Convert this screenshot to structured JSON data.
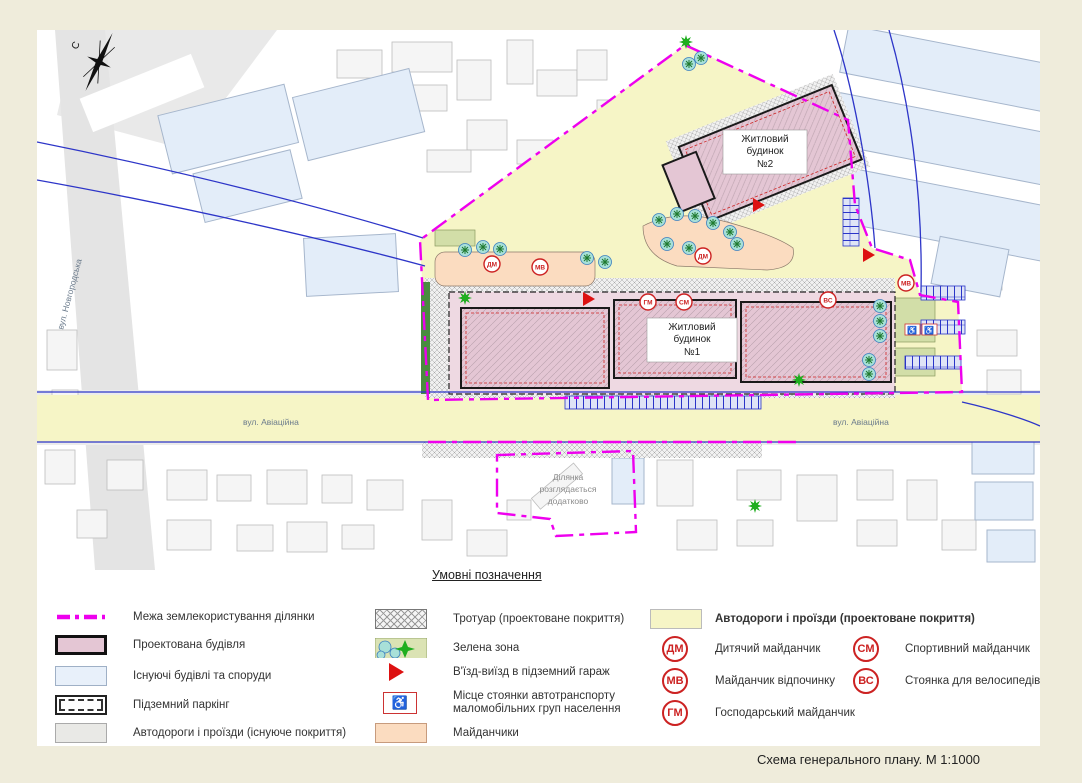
{
  "page": {
    "title": "Схема  генерального плану. М 1:1000"
  },
  "legend": {
    "heading": "Умовні позначення",
    "items": {
      "boundary": "Межа землекористування ділянки",
      "projected_building": "Проектована будівля",
      "existing_buildings": "Існуючі будівлі та споруди",
      "underground_parking": "Підземний паркінг",
      "roads_existing": "Автодороги і проїзди (існуюче покриття)",
      "sidewalk": "Тротуар (проектоване покриття)",
      "green_zone": "Зелена зона",
      "garage_entrance": "В'їзд-виїзд в підземний гараж",
      "disabled_parking": [
        "Місце стоянки автотранспорту",
        "маломобільних груп населення"
      ],
      "playgrounds": "Майданчики",
      "roads_projected": "Автодороги і проїзди (проектоване покриття)"
    },
    "badges": [
      {
        "code": "ДМ",
        "label": "Дитячий майданчик"
      },
      {
        "code": "МВ",
        "label": "Майданчик відпочинку"
      },
      {
        "code": "ГМ",
        "label": "Господарський майданчик"
      },
      {
        "code": "СМ",
        "label": "Спортивний майданчик"
      },
      {
        "code": "ВС",
        "label": "Стоянка для велосипедів"
      }
    ]
  },
  "map": {
    "compass": "С",
    "street_novgorodska": "вул. Новгородська",
    "street_aviatsiina": "вул. Авіаційна",
    "house1": [
      "Житловий",
      "будинок",
      "№1"
    ],
    "house2": [
      "Житловий",
      "будинок",
      "№2"
    ],
    "extra_plot": [
      "Ділянка",
      "розглядається",
      "додатково"
    ],
    "badges": [
      "ДМ",
      "МВ",
      "ДМ",
      "ГМ",
      "СМ",
      "ВС",
      "МВ"
    ],
    "wheelchair_icon": "♿"
  },
  "colors": {
    "background": "#efecdb",
    "boundary_magenta": "#ee00ee",
    "projected_building_pink": "#e4c6d4",
    "existing_building_blue": "#e3edf9",
    "road_projected_yellow": "#f6f5c6",
    "playground_peach": "#fbdcc0",
    "green_zone": "#d2dea8",
    "badge_red": "#cc2222",
    "road_line_blue": "#2d35c8"
  }
}
